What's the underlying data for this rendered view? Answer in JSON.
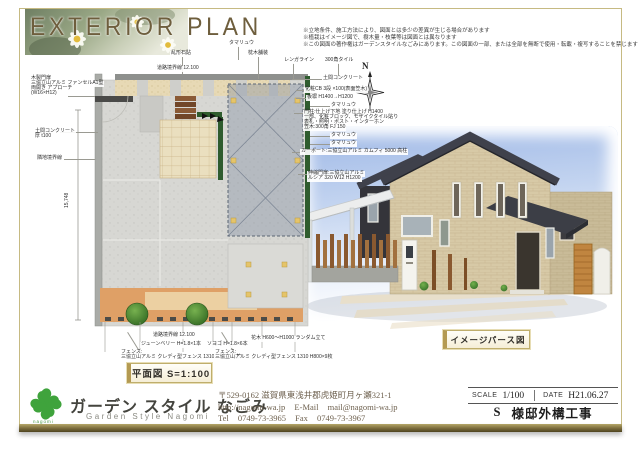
{
  "header": {
    "title": "EXTERIOR PLAN",
    "disclaimers": [
      "※立地条件、施工方法により、図面とは多少の差異が生じる場合があります",
      "※植栽はイメージ図で、樹木量・枝葉等は図面とは異なります",
      "※この図面の著作権はガーデンスタイルなごみにあります。この図面の一部、または全部を無断で使用・転載・複写することを禁じます"
    ]
  },
  "plan": {
    "caption": "平面図  S=1:100",
    "compass": "N",
    "dim_left": "15,748",
    "annotations": {
      "tamaryu_top": "タマリュウ",
      "ishihari": "乱形石貼",
      "makuragi": "枕木舗装",
      "renga": "レンガライン",
      "tile300": "300角タイル",
      "road_top": "道路境界線 12.100",
      "doma_right": "土間コンクリート",
      "cb": "化粧CB 3段 ×100(表面笠木)",
      "itabei": "板塀 H1400→H1200",
      "tamaryu_r1": "タマリュウ",
      "monchu1": "門柱:仕上げ下地 塗り仕上げ H1400",
      "monchu2": "一部、化粧ブロック、モザイクタイル貼り",
      "monchu3": "表札・照明・ポスト・インターホン",
      "monchu4": "笠木:300角 FJ 150",
      "tamaryu_r2": "タマリュウ",
      "tamaryu_r3": "タマリュウ",
      "carport": "カーポート:三協立山アルミ カムフィ 5000 高柱",
      "shukubiki1": "伸縮門扉:三協立山アルミ",
      "shukubiki2": "ルシア 320 W12 H1200",
      "mokusei1": "木製門扉",
      "mokusei2": "三協立山アルミ ファンセルA1型",
      "mokusei3": "両開き アプローチ",
      "mokusei4": "(W16×H12)",
      "doma_l1": "土間コンクリート",
      "doma_l2": "厚 t100",
      "rinchi": "隣地境界線",
      "road_bottom": "道路境界線 12.100",
      "juneberry": "ジューンベリー H=1.8×1本",
      "soyogo": "ソヨゴ H=1.8×6本",
      "fence_l1": "フェンス:",
      "fence_l2": "三協立山アルミ クレディ型フェンス 1310 H1000×6枚",
      "fence_r1": "フェンス:",
      "fence_r2": "三協立山アルミ クレディ型フェンス 1310 H800×9枚",
      "kaboku": "花木 H600〜H1000 ランダム立て"
    }
  },
  "perspective": {
    "caption": "イメージパース図"
  },
  "footer": {
    "logo_text": "nagomi",
    "company_jp": "ガーデン スタイル なごみ",
    "company_en": "Garden Style Nagomi",
    "postal": "〒529-0162 滋賀県東浅井郡虎姫町月ヶ瀬321-1",
    "web": "http://nagomi-wa.jp",
    "email_label": "E-Mail",
    "email": "mail@nagomi-wa.jp",
    "tel_label": "Tel",
    "tel": "0749-73-3965",
    "fax_label": "Fax",
    "fax": "0749-73-3967",
    "titleblock": {
      "scale_label": "SCALE",
      "scale_value": "1/100",
      "date_label": "DATE",
      "date_value": "H21.06.27",
      "owner": "S",
      "project": "様邸外構工事"
    }
  },
  "colors": {
    "frame": "#c6ba82",
    "logo_green": "#3fa33c",
    "sky": "#9db7e6"
  }
}
